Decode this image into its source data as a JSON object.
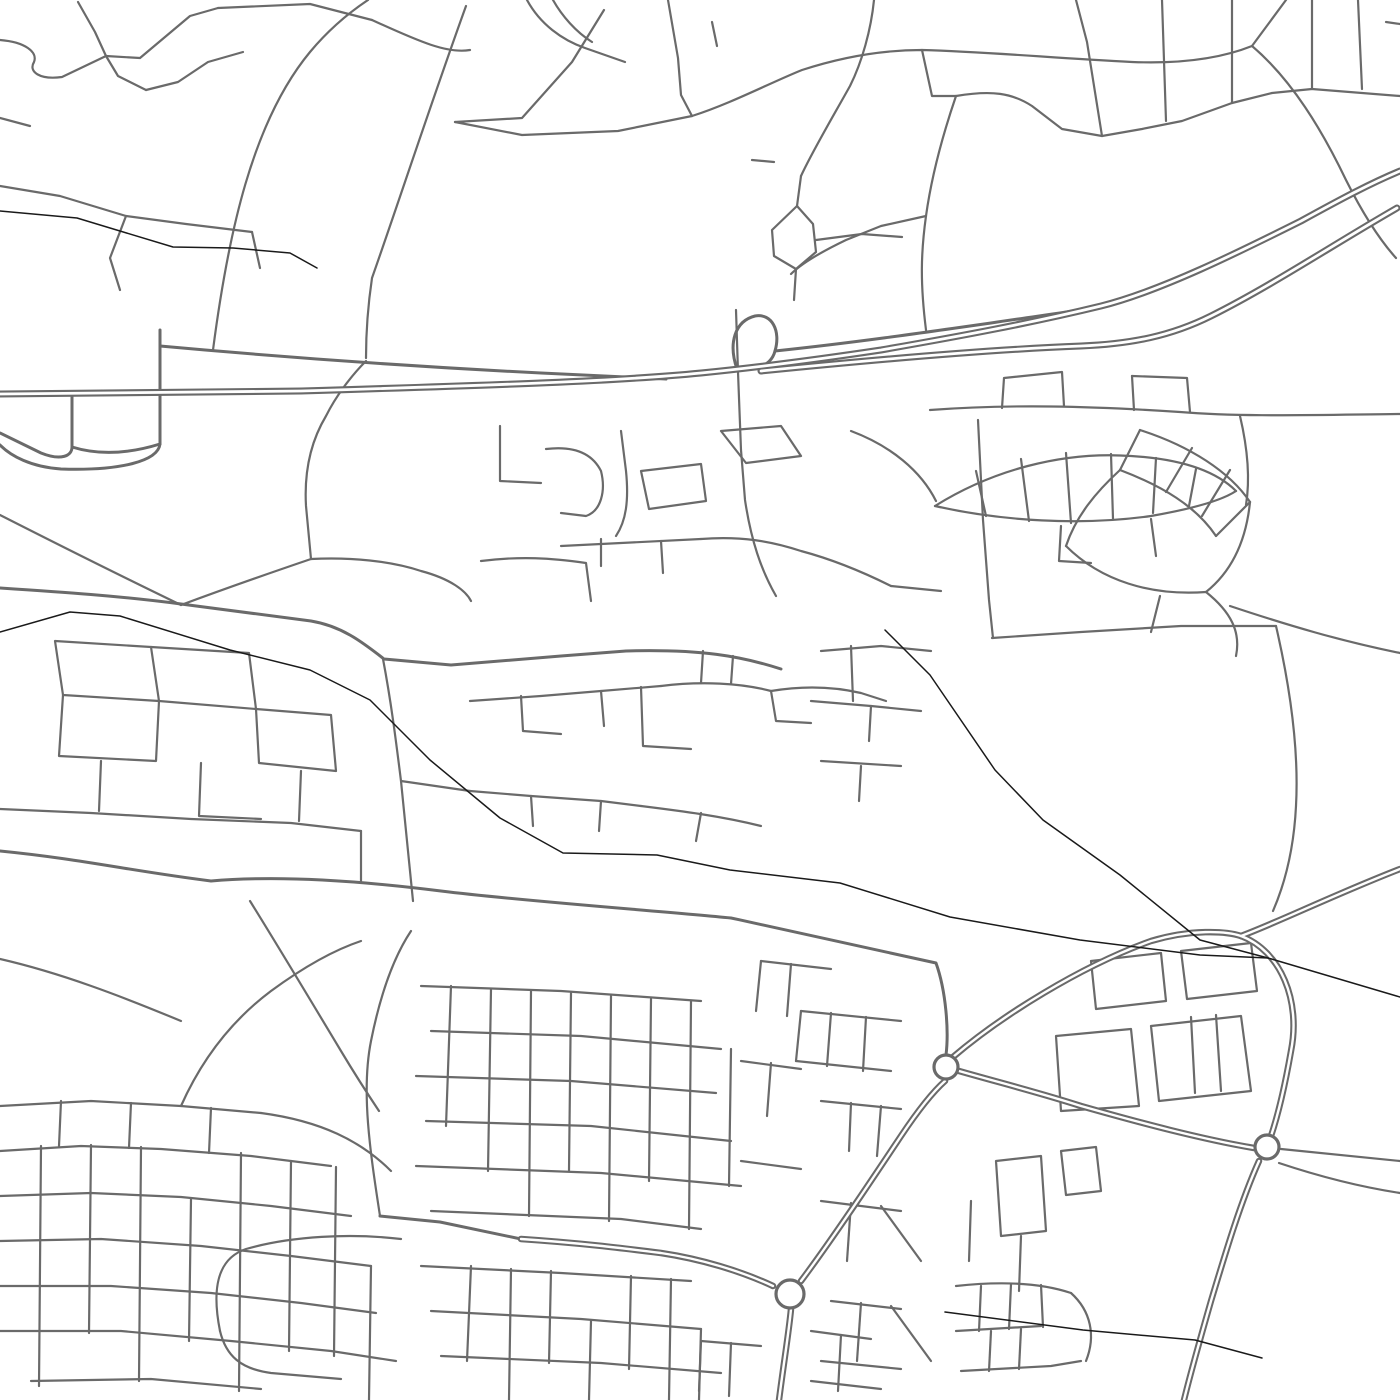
{
  "canvas": {
    "width": 1400,
    "height": 1400,
    "background": "#ffffff"
  },
  "palette": {
    "road": "#6a6a6a",
    "rail": "#1a1a1a",
    "building": "#8a8a8a",
    "inner": "#ffffff"
  },
  "layers": {
    "minor_roads": {
      "width": 2.2,
      "paths": [
        "M0,40 C25,42 38,52 34,62 C28,72 40,80 62,77 L106,56",
        "M78,2 L95,32 L106,56",
        "M106,56 L140,58 L190,16 L218,8",
        "M106,56 L118,76 L146,90",
        "M146,90 L178,82 L208,62 L243,52",
        "M218,8 L310,4 L372,20",
        "M372,20 C420,42 448,54 470,50",
        "M213,350 C228,235 252,122 310,52 C330,28 350,12 368,0",
        "M466,6 C432,100 396,210 372,278 C368,305 366,330 366,358",
        "M0,186 L60,196 L126,216 L186,224 L252,232",
        "M252,232 L260,268",
        "M126,216 L110,258 L120,290",
        "M0,118 L30,126",
        "M527,0 C540,24 562,40 585,48 L625,62",
        "M553,0 C562,16 576,32 592,42",
        "M604,10 L572,62 L522,118 L455,122",
        "M668,0 L678,58 L681,95 L692,116",
        "M692,116 L618,131 L522,135 L455,122",
        "M692,116 C730,104 772,82 802,70 C842,57 882,50 922,50 C992,52 1052,58 1132,62 C1182,64 1222,58 1252,46 L1286,0",
        "M712,22 L717,46",
        "M874,0 C871,30 862,62 850,86 C831,120 812,152 801,176",
        "M801,176 L797,206",
        "M797,206 L772,230 L774,256 L796,269 L816,252 L813,224 Z",
        "M796,269 L794,300",
        "M816,240 L862,234 L902,237",
        "M752,160 L774,162",
        "M922,50 L932,96 L956,96",
        "M956,96 C992,90 1012,93 1032,106 L1062,129 L1102,136 L1142,129 L1182,121 L1232,103 L1272,93 L1312,89",
        "M1076,0 L1087,42 L1102,136",
        "M1162,0 L1166,121",
        "M1232,0 L1232,103",
        "M1312,0 L1312,89",
        "M1312,89 L1400,96",
        "M1358,0 L1362,89",
        "M1252,46 C1292,80 1322,130 1346,180 C1362,212 1378,238 1396,258",
        "M956,96 C941,140 931,180 926,216 C921,252 920,282 926,330",
        "M926,216 L881,226 L846,240 C821,252 801,264 791,274",
        "M1386,22 L1400,24",
        "M930,410 C1010,404 1090,406 1180,412 C1240,417 1310,415 1400,414",
        "M1002,408 L1004,378 L1062,372 L1064,406",
        "M1132,376 L1134,410",
        "M1132,376 L1187,378 L1190,412",
        "M1240,416 C1248,450 1250,480 1246,505",
        "M978,420 L983,520 L989,600 L993,638",
        "M1140,430 C1190,446 1230,472 1250,502",
        "M1120,470 C1162,486 1196,506 1216,536",
        "M1140,430 L1120,470",
        "M1192,448 L1166,492",
        "M1230,470 L1202,516",
        "M1250,502 L1216,536",
        "M1120,470 C1096,492 1076,516 1066,546",
        "M1250,502 C1246,542 1231,572 1206,592",
        "M1066,546 C1101,581 1151,596 1206,592",
        "M1160,596 L1151,632",
        "M1206,592 C1231,612 1241,632 1236,656",
        "M1230,606 C1290,626 1341,641 1400,653",
        "M935,506 C991,471 1061,451 1131,456 C1181,459 1216,471 1236,491",
        "M935,506 C1001,521 1081,526 1151,516 C1191,509 1221,501 1236,491",
        "M976,471 L986,516",
        "M1021,459 L1029,521",
        "M1066,453 L1071,523",
        "M1111,454 L1113,519",
        "M1156,458 L1153,513",
        "M1196,469 L1189,506",
        "M1061,526 L1059,561 L1091,563",
        "M1151,519 L1156,556",
        "M992,638 L1081,632 L1181,626 L1276,626",
        "M1276,626 C1291,691 1299,751 1296,806 C1294,846 1286,881 1273,911",
        "M500,426 L500,481 L541,483",
        "M546,449 C571,446 591,451 601,471 C606,491 601,511 586,516 L561,513",
        "M621,431 L626,471 C629,501 626,521 616,536",
        "M641,471 L701,464 L706,501 L649,509 Z",
        "M721,431 L781,426 L801,456 L746,463 Z",
        "M851,431 C891,446 921,471 936,501",
        "M561,546 L701,539",
        "M601,539 L601,566",
        "M661,541 L663,573",
        "M481,561 C521,556 551,558 586,563 L591,601",
        "M701,539 C741,536 771,541 801,551 C831,559 861,571 891,586",
        "M891,586 L941,591",
        "M736,310 L738,372 L741,450 L745,500 C751,540 761,570 776,596",
        "M470,701 L541,696 L601,691 L661,686",
        "M521,696 L523,731 L561,734",
        "M601,691 L604,726",
        "M641,687 L643,746 L691,749",
        "M661,686 C701,681 741,683 771,691",
        "M771,691 L776,721 L811,723",
        "M771,691 C801,686 831,686 861,693 L886,701",
        "M701,683 L703,651",
        "M731,684 L733,656",
        "M470,791 L531,796 L601,801 L641,806",
        "M531,796 L533,826",
        "M601,801 L599,831",
        "M641,806 C681,811 721,816 761,826",
        "M701,813 L696,841",
        "M811,701 L871,706 L921,711",
        "M871,706 L869,741",
        "M821,761 L901,766",
        "M861,766 L859,801",
        "M821,651 L881,646 L931,651",
        "M851,646 L853,701",
        "M55,641 L151,647 L159,701 L63,695 Z",
        "M151,647 L249,653 L256,709 L159,701",
        "M63,695 L59,756 L156,761 L159,701",
        "M256,709 L331,715 L336,771 L259,763 Z",
        "M101,761 L99,811",
        "M201,763 L199,816 L261,819",
        "M301,771 L299,821",
        "M0,809 L91,813 L191,819 L291,823 L361,831",
        "M361,831 L361,881",
        "M0,515 C61,546 121,576 181,605",
        "M311,559 C261,576 216,592 181,605",
        "M311,559 L306,506 C304,471 311,441 326,416 C336,396 351,376 366,361",
        "M311,559 C351,557 391,561 421,571 C451,579 466,591 471,601",
        "M383,659 C391,701 396,741 401,781 C406,831 409,861 413,901",
        "M401,781 L470,791",
        "M0,959 C61,973 121,996 181,1021",
        "M250,901 C281,951 311,1001 341,1051 C356,1076 369,1096 379,1111",
        "M380,1216 C370,1151 361,1091 371,1041 C379,1001 391,961 411,931",
        "M421,986 L561,991 L701,1001",
        "M431,1031 L581,1036 L721,1049",
        "M416,1076 L571,1081 L716,1093",
        "M426,1121 L591,1126 L731,1141",
        "M416,1166 L601,1173 L741,1186",
        "M431,1211 L621,1219 L701,1229",
        "M451,986 L446,1126",
        "M491,989 L488,1171",
        "M531,991 L529,1216",
        "M571,993 L569,1171",
        "M611,996 L609,1221",
        "M651,999 L649,1181",
        "M691,1001 L689,1229",
        "M731,1049 L729,1186",
        "M421,1266 L561,1273 L691,1281",
        "M431,1311 L581,1319 L701,1329",
        "M441,1356 L601,1363 L721,1373",
        "M471,1266 L467,1361",
        "M511,1269 L509,1400",
        "M551,1271 L549,1363",
        "M591,1321 L589,1400",
        "M631,1276 L629,1369",
        "M671,1279 L669,1400",
        "M701,1329 L699,1400",
        "M220,1331 C212,1291 216,1259 246,1249 C291,1236 351,1233 401,1239",
        "M220,1331 C226,1356 241,1369 271,1373 L341,1379",
        "M801,1011 L901,1021",
        "M801,1011 L796,1061",
        "M831,1013 L827,1066",
        "M866,1017 L863,1071",
        "M796,1061 L891,1071",
        "M821,1101 L901,1109",
        "M851,1103 L849,1151",
        "M881,1106 L877,1156",
        "M761,961 L831,969",
        "M761,961 L756,1011",
        "M791,964 L787,1016",
        "M741,1061 L801,1069",
        "M771,1063 L767,1116",
        "M741,1161 L801,1169",
        "M821,1201 L901,1211",
        "M851,1203 L847,1261",
        "M881,1206 L921,1261",
        "M831,1301 L901,1309",
        "M861,1303 L857,1361",
        "M891,1306 L931,1361",
        "M821,1361 L901,1369",
        "M701,1341 L761,1346",
        "M701,1341 L699,1391",
        "M731,1343 L729,1396",
        "M811,1331 L871,1339",
        "M841,1335 L838,1391",
        "M811,1381 L881,1389",
        "M0,1106 L91,1101 L181,1106 L261,1113",
        "M61,1101 L59,1146",
        "M131,1103 L129,1148",
        "M211,1108 L209,1153",
        "M261,1113 C321,1121 361,1141 391,1171",
        "M0,1151 L81,1146 L161,1149 L251,1156 L331,1166",
        "M0,1196 L91,1193 L181,1197 L271,1206 L351,1216",
        "M0,1241 L101,1239 L201,1246 L291,1256 L371,1266",
        "M0,1286 L111,1286 L211,1293 L301,1303 L376,1313",
        "M0,1331 L121,1331 L231,1341 L331,1351 L396,1361",
        "M31,1381 L151,1379 L261,1389",
        "M41,1146 L39,1386",
        "M91,1145 L89,1333",
        "M141,1147 L139,1381",
        "M191,1199 L189,1341",
        "M241,1153 L239,1391",
        "M291,1161 L289,1351",
        "M336,1167 L334,1356",
        "M371,1266 L369,1400",
        "M181,1106 C201,1061 231,1021 271,991 C301,969 331,951 361,941",
        "M1061,1111 L1056,1036 L1131,1029 L1139,1106 Z",
        "M1151,1026 L1241,1016 L1251,1091 L1159,1101 Z",
        "M1091,961 L1161,953 L1166,1001 L1096,1009 Z",
        "M1181,951 L1251,943 L1257,991 L1187,999 Z",
        "M1191,1017 L1195,1093",
        "M1216,1015 L1221,1091",
        "M996,1161 L1041,1156 L1046,1231 L1001,1236 Z",
        "M1061,1151 L1096,1147 L1101,1191 L1066,1195 Z",
        "M1021,1236 L1019,1291",
        "M971,1201 L969,1261",
        "M956,1286 C1001,1281 1041,1283 1071,1293",
        "M1071,1293 C1091,1311 1096,1336 1086,1361",
        "M956,1331 L1041,1326",
        "M981,1286 L979,1331",
        "M1011,1284 L1009,1329",
        "M1041,1285 L1043,1327",
        "M961,1371 L1051,1366 L1081,1361",
        "M991,1331 L989,1371",
        "M1021,1329 L1019,1369",
        "M1281,1149 L1400,1161",
        "M1279,1163 C1321,1177 1361,1187 1400,1193"
      ]
    },
    "arterial_roads": {
      "width": 3,
      "paths": [
        "M160,330 L160,444",
        "M160,444 C158,461 121,471 61,469 C31,467 11,456 0,445",
        "M72,397 L72,447",
        "M72,447 C72,456 61,461 41,453 L0,433",
        "M72,447 C101,456 131,453 160,444",
        "M160,346 C281,357 421,367 541,373 C601,376 641,378 666,379",
        "M0,588 C61,592 121,596 181,604 C241,612 281,617 311,621 C341,626 361,641 384,659 L451,665 L561,656 L626,651 C701,649 741,656 781,669",
        "M0,851 C81,859 131,871 211,881 C281,875 361,881 441,891 C521,901 661,911 731,918 C801,933 871,949 936,963 C946,991 949,1031 946,1055",
        "M380,1216 L440,1222 L521,1239",
        "M737,369 C728,343 735,321 755,316 C772,313 781,331 775,351 C773,359 767,365 759,367",
        "M775,351 C851,343 921,333 991,323 C1031,317 1061,313 1086,309"
      ]
    },
    "dual_carriageways": {
      "casing_width": 6.5,
      "inner_width": 2.4,
      "paths": [
        "M521,1239 C581,1243 621,1248 661,1253 C701,1259 741,1271 773,1286",
        "M791,1309 C789,1331 784,1361 779,1400",
        "M801,1281 C831,1241 871,1181 901,1136 C921,1106 936,1089 945,1081",
        "M953,1057 C1001,1016 1081,966 1151,941 C1191,929 1226,931 1241,936",
        "M1241,936 C1281,921 1331,896 1400,869",
        "M1241,936 C1281,951 1301,1001 1291,1051 C1284,1091 1276,1121 1271,1136",
        "M959,1071 C1001,1083 1041,1093 1081,1106 C1141,1123 1201,1139 1254,1148",
        "M1259,1161 C1241,1201 1226,1251 1211,1301 C1201,1336 1191,1371 1184,1400"
      ]
    },
    "motorway": {
      "casing_width": 7,
      "inner_width": 2.8,
      "paths": [
        "M0,394 L301,391 C501,385 621,381 701,373 C761,367 821,359 881,350 C961,336 1031,323 1101,306 C1161,291 1241,251 1301,221 C1341,199 1371,183 1400,171",
        "M761,371 C901,357 1001,349 1081,346 C1131,344 1171,336 1211,316 C1271,286 1331,246 1397,208"
      ]
    },
    "railways": {
      "width": 1.5,
      "paths": [
        "M0,211 L77,218 L173,247 L233,248 L290,253 L317,268",
        "M0,632 L70,612 L120,616 L230,650 L310,670 L370,700 L430,760 L500,818 L563,853 L657,855 L730,870 L840,883 L950,917 L1080,940 L1200,955 L1268,958 L1400,997",
        "M885,630 L930,675 L995,770 L1043,820 L1120,875 L1200,940 L1268,958",
        "M945,1312 L1083,1330 L1195,1340 L1262,1358"
      ]
    },
    "roundabouts": {
      "ring_width": 3.2,
      "items": [
        {
          "cx": 946,
          "cy": 1067,
          "r": 12
        },
        {
          "cx": 790,
          "cy": 1294,
          "r": 14
        },
        {
          "cx": 1267,
          "cy": 1147,
          "r": 12
        }
      ]
    },
    "buildings": {
      "paths": [
        "M1186,1262 L1212,1270 L1208,1284 L1182,1276 Z"
      ]
    }
  }
}
